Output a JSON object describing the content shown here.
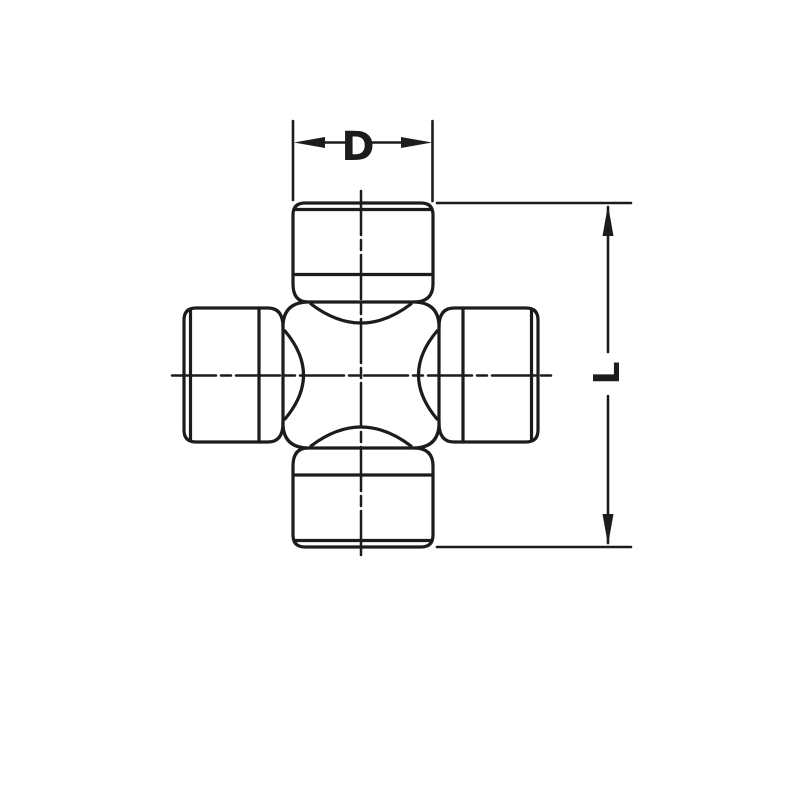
{
  "diagram": {
    "labels": {
      "width_dimension": "D",
      "length_dimension": "L"
    },
    "colors": {
      "line": "#1c1c1c",
      "background": "#ffffff"
    }
  }
}
